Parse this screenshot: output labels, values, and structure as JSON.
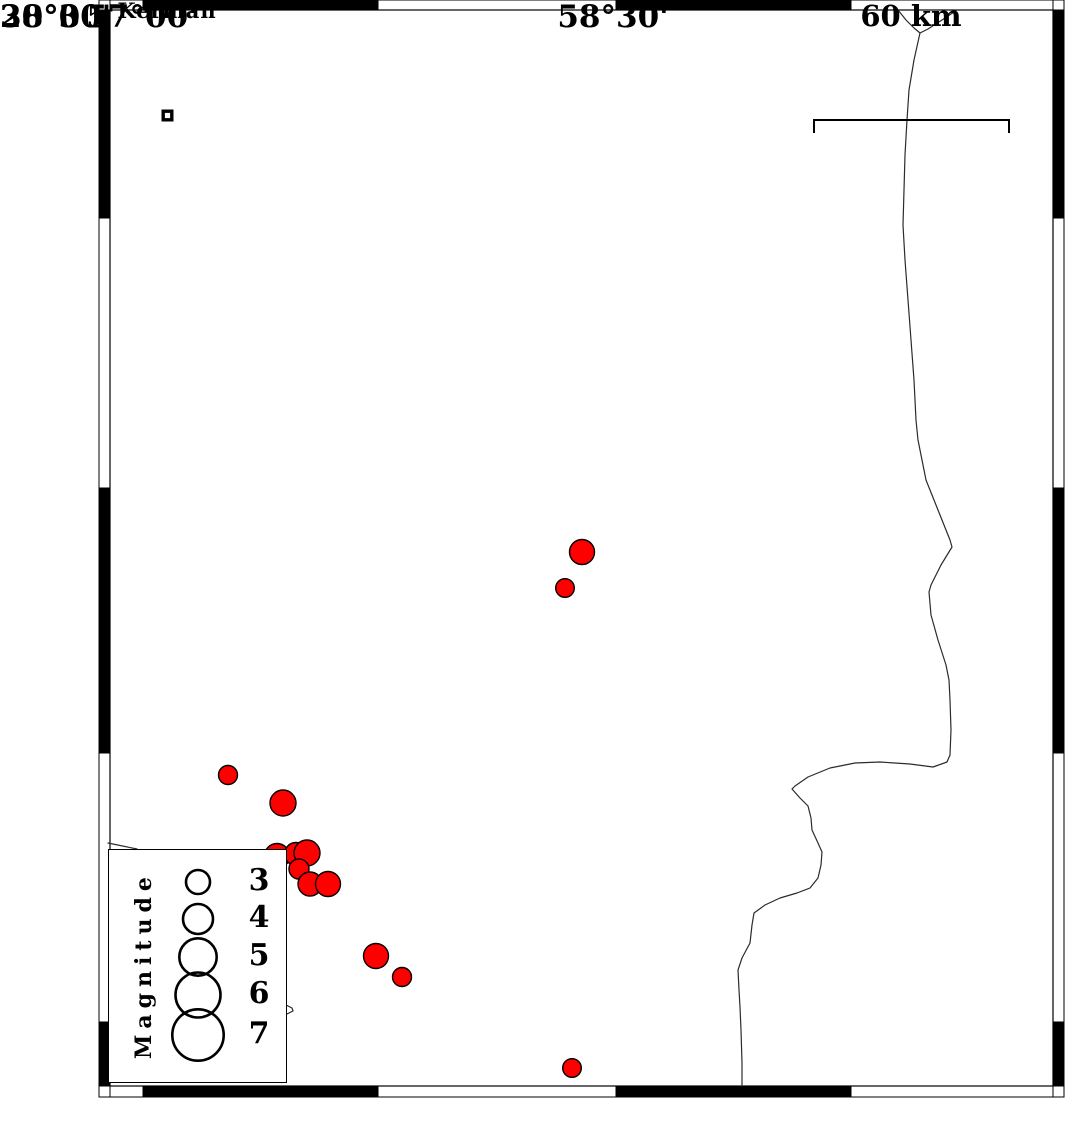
{
  "map": {
    "city": {
      "label": "Kerman",
      "x": 167.5,
      "y": 115.5
    },
    "scale_bar": {
      "label": "60 km",
      "x1": 814,
      "x2": 1009,
      "y": 120,
      "tick_drop": 13
    },
    "axis": {
      "lat_labels": [
        {
          "text": "30°00'",
          "y": 218
        },
        {
          "text": "28°30'",
          "y": 753
        }
      ],
      "lon_labels": [
        {
          "text": "57°00'",
          "x": 143
        },
        {
          "text": "58°30'",
          "x": 617
        }
      ]
    },
    "frame": {
      "outer": {
        "x": 99,
        "y": 0,
        "w": 965,
        "h": 1097
      },
      "inner": {
        "x": 110,
        "y": 10,
        "w": 943,
        "h": 1076
      },
      "ticks_x": [
        143,
        378,
        616,
        851
      ],
      "ticks_y": [
        218,
        488,
        753,
        1022
      ]
    },
    "legend": {
      "title": "Magnitude",
      "entries": [
        {
          "label": "3",
          "r": 12
        },
        {
          "label": "4",
          "r": 15
        },
        {
          "label": "5",
          "r": 18.7
        },
        {
          "label": "6",
          "r": 22.5
        },
        {
          "label": "7",
          "r": 25.7
        }
      ],
      "entry_y": [
        32,
        69,
        107,
        145,
        185
      ],
      "circle_x": 89
    },
    "earthquakes": [
      {
        "x": 582,
        "y": 552,
        "r": 12.5
      },
      {
        "x": 565,
        "y": 588,
        "r": 9.3
      },
      {
        "x": 228,
        "y": 775,
        "r": 9.5
      },
      {
        "x": 283,
        "y": 803,
        "r": 13
      },
      {
        "x": 277,
        "y": 856,
        "r": 12.5
      },
      {
        "x": 296,
        "y": 854,
        "r": 11.5
      },
      {
        "x": 307,
        "y": 853,
        "r": 13
      },
      {
        "x": 299,
        "y": 869,
        "r": 10
      },
      {
        "x": 310,
        "y": 884,
        "r": 12
      },
      {
        "x": 328,
        "y": 884,
        "r": 12.5
      },
      {
        "x": 376,
        "y": 956,
        "r": 12.5
      },
      {
        "x": 402,
        "y": 977,
        "r": 9.5
      },
      {
        "x": 572,
        "y": 1068,
        "r": 9.3
      }
    ],
    "roads": {
      "branch_a": [
        [
          898,
          10
        ],
        [
          906,
          20
        ],
        [
          914,
          28
        ],
        [
          920,
          33
        ]
      ],
      "branch_b": [
        [
          957,
          10
        ],
        [
          942,
          20
        ],
        [
          928,
          29
        ],
        [
          920,
          33
        ]
      ],
      "main": [
        [
          920,
          33
        ],
        [
          914,
          60
        ],
        [
          909,
          90
        ],
        [
          907,
          120
        ],
        [
          905,
          155
        ],
        [
          904,
          190
        ],
        [
          903,
          225
        ],
        [
          905,
          260
        ],
        [
          908,
          300
        ],
        [
          911,
          340
        ],
        [
          914,
          380
        ],
        [
          916,
          420
        ],
        [
          918,
          440
        ],
        [
          926,
          480
        ],
        [
          940,
          515
        ],
        [
          950,
          540
        ],
        [
          952,
          547
        ],
        [
          941,
          565
        ],
        [
          931,
          585
        ],
        [
          929,
          592
        ],
        [
          931,
          615
        ],
        [
          938,
          640
        ],
        [
          946,
          665
        ],
        [
          949,
          680
        ],
        [
          950,
          700
        ],
        [
          951,
          730
        ],
        [
          950,
          755
        ],
        [
          947,
          762
        ],
        [
          933,
          767
        ],
        [
          910,
          764
        ],
        [
          880,
          762
        ],
        [
          855,
          763
        ],
        [
          830,
          768
        ],
        [
          808,
          777
        ],
        [
          795,
          786
        ],
        [
          792,
          789
        ],
        [
          800,
          798
        ],
        [
          808,
          806
        ],
        [
          811,
          818
        ],
        [
          812,
          830
        ],
        [
          818,
          843
        ],
        [
          822,
          852
        ],
        [
          821,
          865
        ],
        [
          818,
          878
        ],
        [
          810,
          888
        ],
        [
          797,
          893
        ],
        [
          780,
          898
        ],
        [
          765,
          905
        ],
        [
          754,
          913
        ],
        [
          752,
          925
        ],
        [
          750,
          943
        ],
        [
          742,
          958
        ],
        [
          738,
          970
        ],
        [
          739,
          990
        ],
        [
          740,
          1007
        ],
        [
          741,
          1030
        ],
        [
          742,
          1063
        ],
        [
          742,
          1086
        ]
      ],
      "legend_line": [
        [
          108,
          843
        ],
        [
          137,
          849
        ],
        [
          210,
          928
        ],
        [
          275,
          995
        ],
        [
          286,
          1005
        ],
        [
          292,
          1008
        ],
        [
          293,
          1011
        ],
        [
          287,
          1014
        ]
      ]
    },
    "colors": {
      "earthquake": "#ff0000",
      "outline": "#000000",
      "road": "#2b2b2b",
      "frame_black": "#000000",
      "frame_white": "#ffffff"
    }
  }
}
